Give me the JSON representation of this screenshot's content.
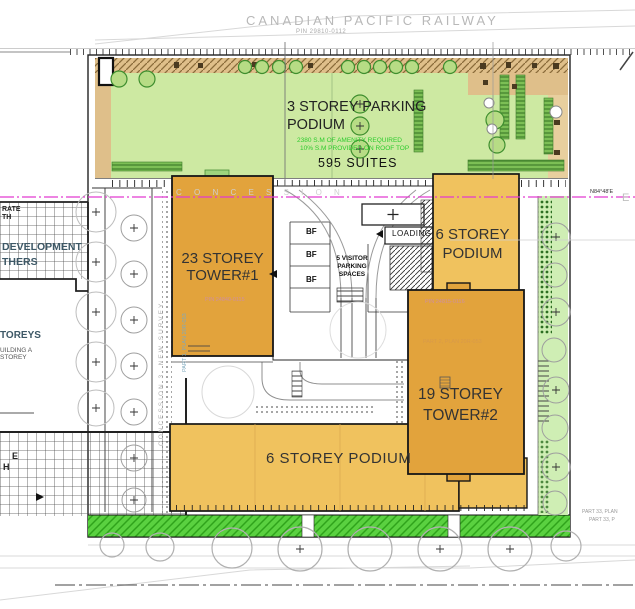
{
  "railway": {
    "name": "CANADIAN  PACIFIC  RAILWAY",
    "pin": "PIN 29810-0112"
  },
  "roof": {
    "label1": "3 STOREY PARKING",
    "label2": "PODIUM",
    "amenity1": "2380 S.M OF AMENITY REQUIRED",
    "amenity2": "10% S.M PROVIDED ON ROOF TOP",
    "suites": "595 SUITES"
  },
  "buildings": {
    "tower1_line1": "23 STOREY",
    "tower1_line2": "TOWER#1",
    "tower1_pin": "PIN 24840-0115",
    "tower1_part": "PART 1, PLAN 20R-053",
    "podium_east_line1": "6 STOREY",
    "podium_east_line2": "PODIUM",
    "tower2_line1": "19 STOREY",
    "tower2_line2": "TOWER#2",
    "tower2_pin": "PIN 24815-0116",
    "tower2_part": "PART 2, PLAN 20R-053",
    "podium_south": "6 STOREY PODIUM"
  },
  "parking": {
    "bf": "BF",
    "visitor1": "5 VISITOR",
    "visitor2": "PARKING",
    "visitor3": "SPACES",
    "loading": "LOADING"
  },
  "survey": {
    "concession": "C O N C E S S I O N",
    "concession_vertical": "CONCESSION 3, NEW SURVEY",
    "bearing": "N84°48'E",
    "east_letter": "E",
    "part33a": "PART 33, PLAN",
    "part33b": "PART 33, P"
  },
  "neighbor": {
    "frag1": "RATE",
    "frag2": "TH",
    "frag3": "DEVELOPMENT",
    "frag4": "THERS",
    "frag5": "TOREYS",
    "frag6": "UILDING A",
    "frag7": "STOREY",
    "frag8": "E",
    "frag9": "H"
  },
  "colors": {
    "tower_orange": "#e2a33c",
    "podium_orange": "#f0c25e",
    "roof_green": "#cde9a2",
    "strip_green": "#5ad140",
    "tan": "#dfbf8a",
    "magenta": "#e23ad0"
  }
}
